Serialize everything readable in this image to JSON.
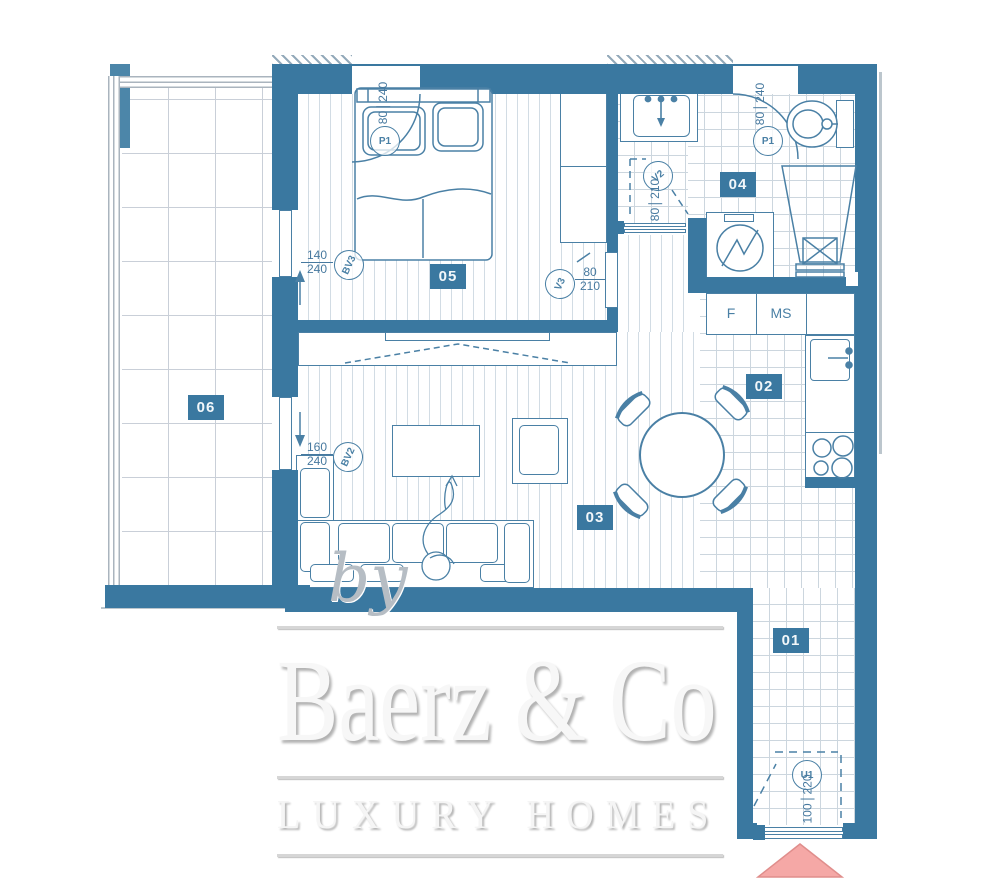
{
  "palette": {
    "wall_blue": "#3a78a0",
    "line_blue": "#4a80a5",
    "floor_line": "#d2dce4",
    "tile_line": "#ccd6de",
    "glass_gray": "#aab4be",
    "entry_arrow_pink": "#f5a8a6",
    "watermark_gray": "#d6d6d6"
  },
  "rooms": {
    "r01": "01",
    "r02": "02",
    "r03": "03",
    "r04": "04",
    "r05": "05",
    "r06": "06"
  },
  "tags": {
    "p1": "P1",
    "v2": "V2",
    "v3": "V3",
    "bv2": "BV2",
    "bv3": "BV3",
    "u1": "U1"
  },
  "dims": {
    "p1_bed": {
      "w": "80",
      "h": "240"
    },
    "p1_bath": {
      "w": "80",
      "h": "240"
    },
    "v2": {
      "w": "80",
      "h": "210"
    },
    "v3": {
      "w": "80",
      "h": "210"
    },
    "bv3": {
      "w": "140",
      "h": "240"
    },
    "bv2": {
      "w": "160",
      "h": "240"
    },
    "u1": {
      "w": "100",
      "h": "220"
    }
  },
  "kitchen": {
    "fridge_label": "F",
    "ms_label": "MS"
  },
  "watermark": {
    "by": "by",
    "brand": "Baerz & Co",
    "tagline": "LUXURY HOMES"
  }
}
